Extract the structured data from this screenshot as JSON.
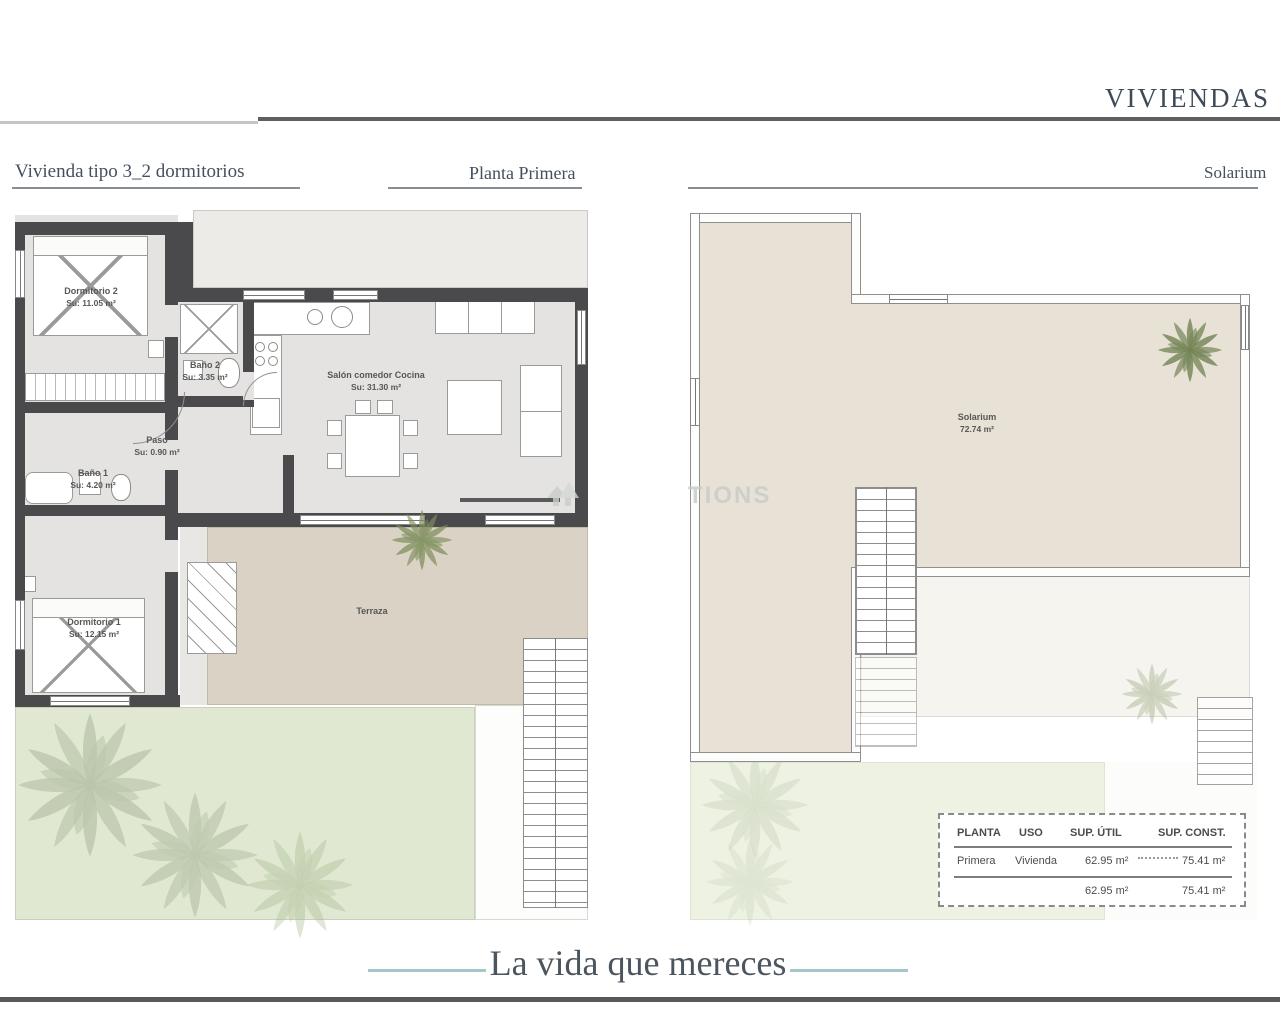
{
  "header": {
    "brand": "VIVIENDAS"
  },
  "left_plan": {
    "title": "Vivienda tipo 3_2 dormitorios",
    "sheet_label": "Planta Primera",
    "rooms": {
      "dormitorio2": {
        "name": "Dormitorio 2",
        "area": "Su: 11.05 m²"
      },
      "bano2": {
        "name": "Baño 2",
        "area": "Su: 3.35 m²"
      },
      "paso": {
        "name": "Paso",
        "area": "Su: 0.90 m²"
      },
      "bano1": {
        "name": "Baño 1",
        "area": "Su: 4.20 m²"
      },
      "dormitorio1": {
        "name": "Dormitorio 1",
        "area": "Su: 12.15 m²"
      },
      "salon": {
        "name": "Salón comedor Cocina",
        "area": "Su: 31.30 m²"
      },
      "terraza": {
        "name": "Terraza"
      }
    }
  },
  "right_plan": {
    "sheet_label": "Solarium",
    "rooms": {
      "solarium": {
        "name": "Solarium",
        "area": "72.74 m²"
      }
    }
  },
  "summary_table": {
    "headers": {
      "planta": "PLANTA",
      "uso": "USO",
      "sup_util": "SUP. ÚTIL",
      "sup_const": "SUP. CONST."
    },
    "row": {
      "planta": "Primera",
      "uso": "Vivienda",
      "sup_util": "62.95 m²",
      "sup_const": "75.41 m²"
    },
    "totals": {
      "sup_util": "62.95 m²",
      "sup_const": "75.41 m²"
    }
  },
  "footer": {
    "tagline": "La vida que mereces"
  },
  "watermark": {
    "icon": "house-icon",
    "visible_text": "TIONS"
  },
  "colors": {
    "heading": "#3e4a58",
    "accent_teal": "#a3c8ca",
    "wall_dark": "#4a4a4c",
    "terrace_beige": "#dad2c4",
    "solarium_beige": "#e7e1d6",
    "garden_green": "#e0e8d2"
  }
}
